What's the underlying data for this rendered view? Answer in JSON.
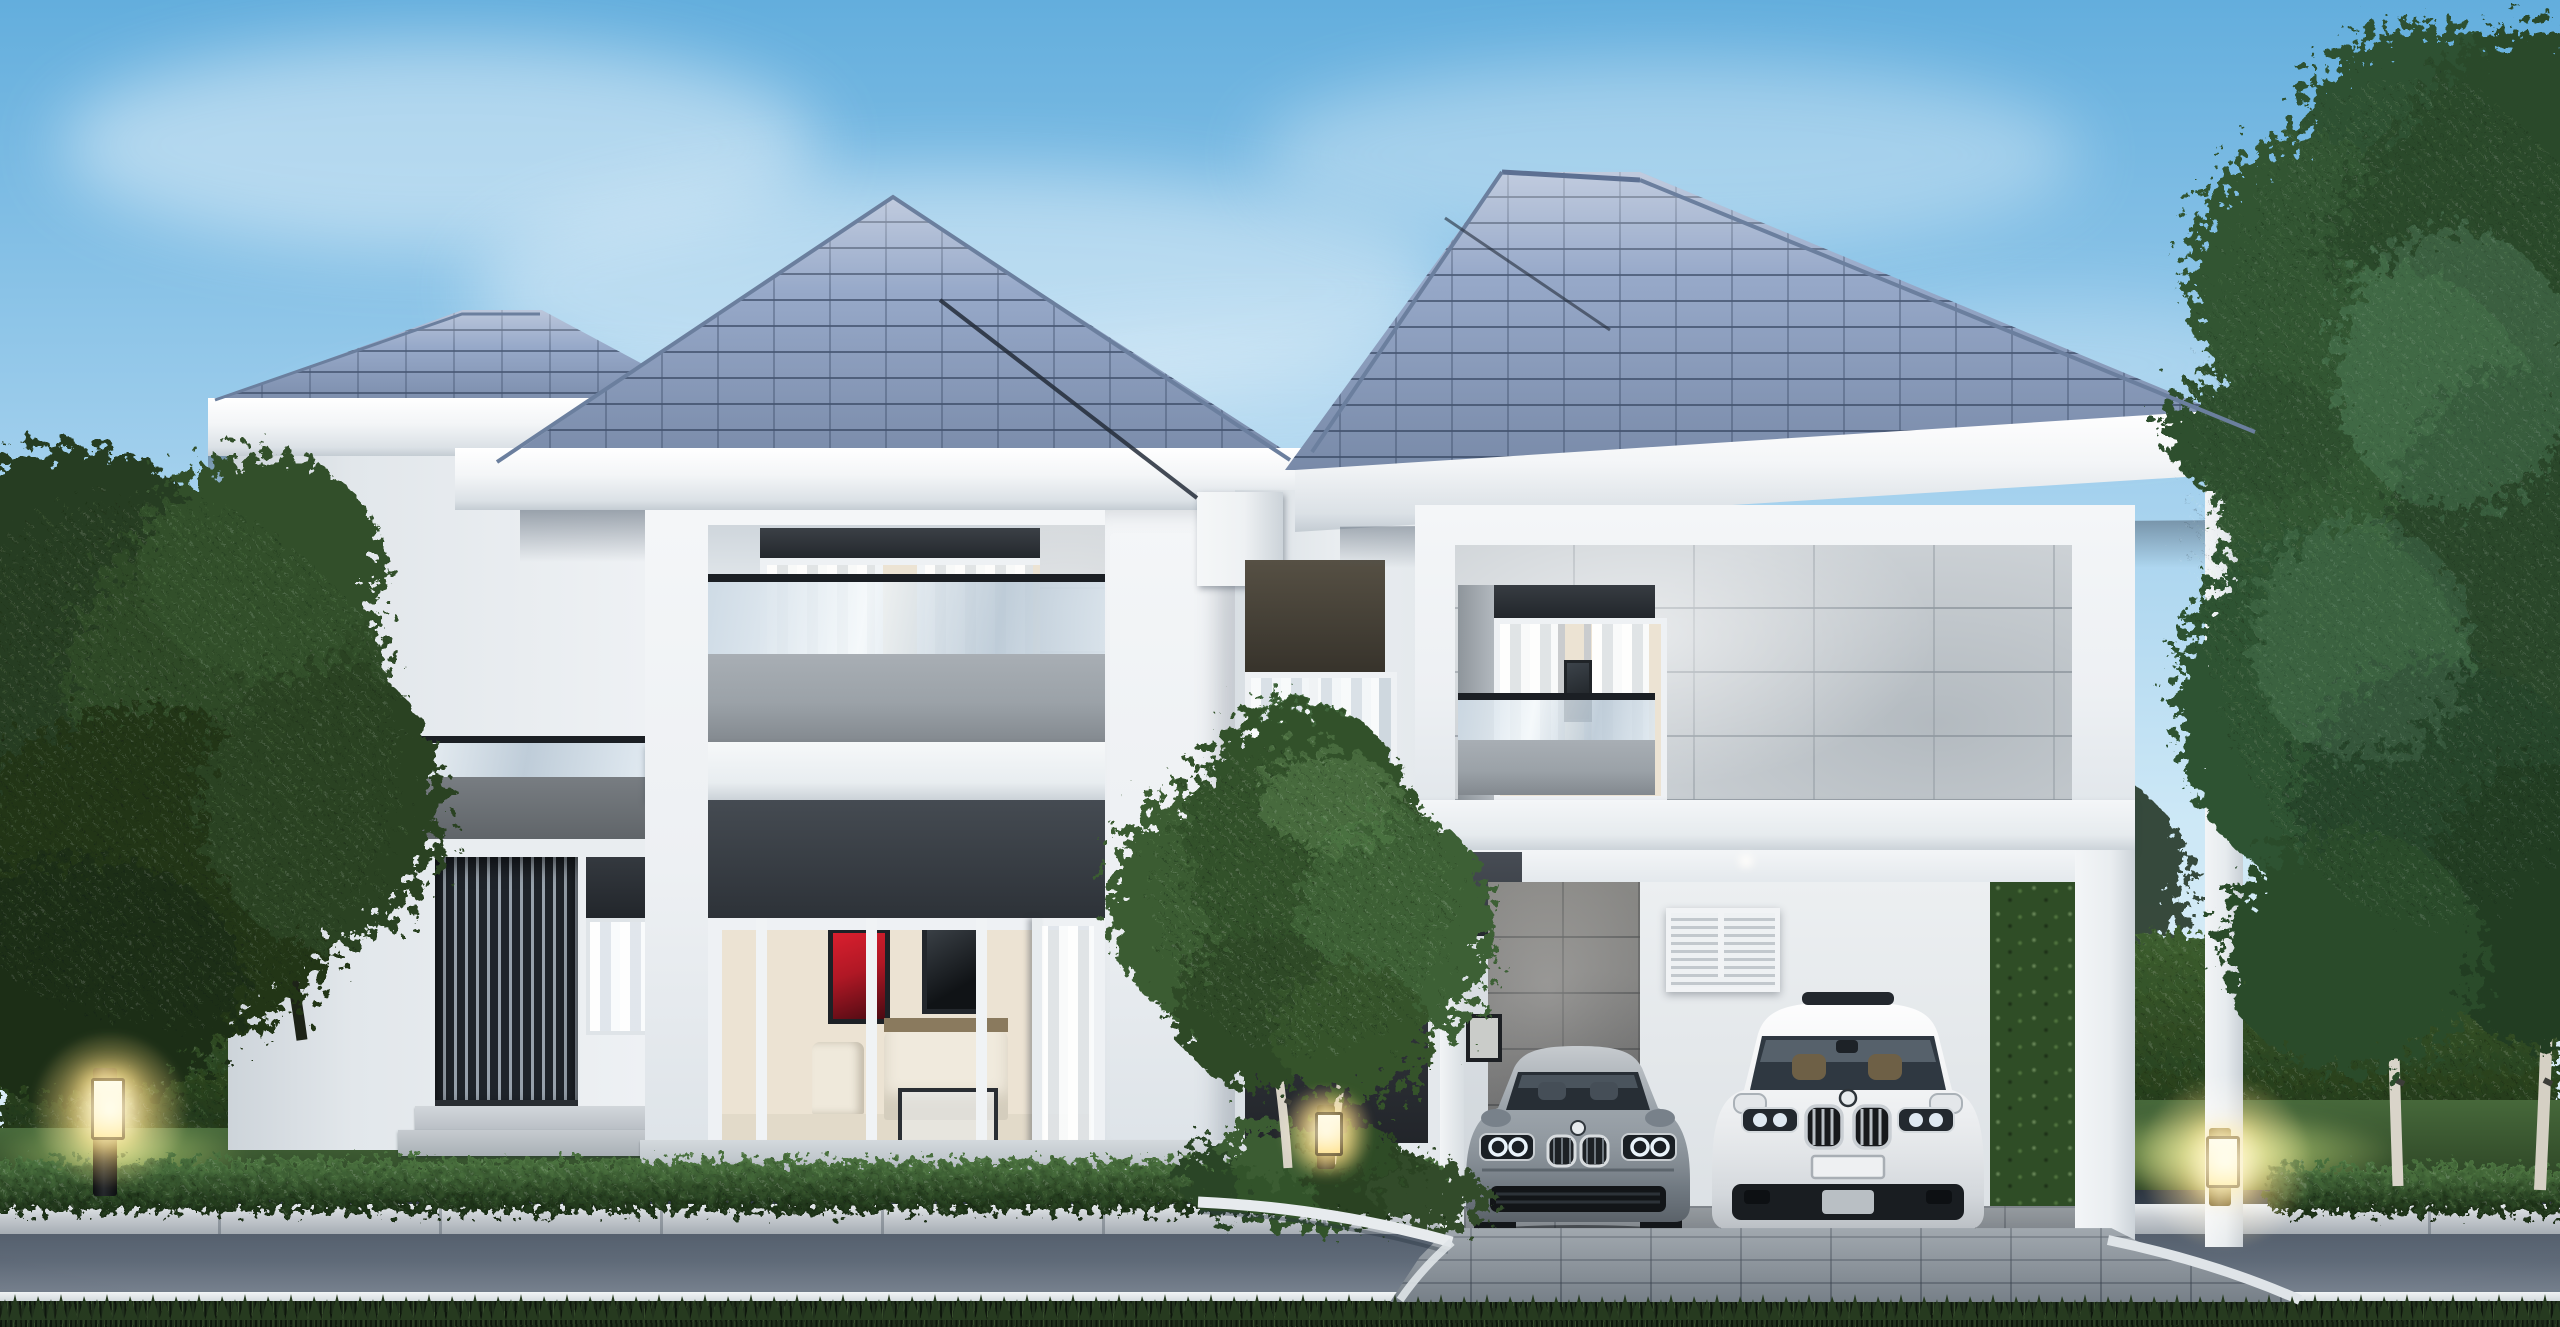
{
  "scene": {
    "type": "architectural-exterior-render",
    "subject": "modern two-storey detached house at dusk",
    "view": "front elevation from street",
    "elements": [
      "hip roof with slate tiles",
      "white render walls",
      "stone tile cladding",
      "carport with two cars",
      "landscaped garden",
      "asphalt road foreground"
    ]
  },
  "palette": {
    "sky_top": "#63aedd",
    "sky_mid": "#a6d2ee",
    "sky_low": "#cde8f6",
    "roof_tile": "#97a9c9",
    "fascia": "#f3f5f7",
    "wall": "#edf0f3",
    "stone": "#ced3d7",
    "panel_dark": "#3c4148",
    "charcoal": "#33373d",
    "parapet": "#9ba2a8",
    "rail": "#1b1f24",
    "hedge": "#2a431f",
    "lawn": "#35502c",
    "curb_dark": "#333d4a",
    "curb_stone": "#c5cacf",
    "road": "#5f6a78",
    "grass_fg": "#20301c",
    "paver": "#98a1a9",
    "lamp_glow": "#ffd685",
    "sedan_body": "#8d969e",
    "suv_body": "#edeff1",
    "interior_warm": "#ece3d3",
    "art_red": "#b01825"
  },
  "house": {
    "left_rear_wing": {
      "features": [
        "hip-roof",
        "balcony-glass-railing",
        "gray-spandrel-panel",
        "vertical-slat-screen",
        "side-window",
        "stone-steps"
      ]
    },
    "left_front_wing": {
      "features": [
        "hip-roof",
        "recessed-balcony",
        "sheer-curtains",
        "stone-pier",
        "glass-balcony-railing",
        "gray-parapet",
        "living-room-sliding-doors",
        "red-artwork",
        "dark-artwork",
        "cream-sofa",
        "armchair",
        "glass-coffee-table",
        "terrace-step"
      ]
    },
    "middle_section": {
      "features": [
        "valley-parapet-box",
        "bronze-transom",
        "tall-mullioned-window",
        "charcoal-feature-wall",
        "planting-bed",
        "white-garden-curb"
      ]
    },
    "right_wing": {
      "features": [
        "hip-roof",
        "stone-clad-upper-box",
        "recessed-balcony-window",
        "glass-railing",
        "carport",
        "ceiling-downlight",
        "interior-stone-wall",
        "louvered-shutter-window",
        "framed-photo",
        "corner-columns"
      ]
    }
  },
  "vehicles": [
    {
      "name": "luxury-sedan",
      "color_name": "silver-gray",
      "facing": "front",
      "details": [
        "twin-kidney-grille",
        "roundel-badge",
        "quad-ring-headlights",
        "black-lower-intake"
      ]
    },
    {
      "name": "luxury-suv",
      "color_name": "white",
      "facing": "front",
      "details": [
        "twin-kidney-grille",
        "roundel-badge",
        "sunroof",
        "blank-license-plate",
        "black-lower-bumper"
      ]
    }
  ],
  "landscape": {
    "garden_lamps": [
      {
        "position": "left-lawn",
        "style": "bollard",
        "lit": true
      },
      {
        "position": "center-planting-bed",
        "style": "mini-bollard",
        "lit": true
      },
      {
        "position": "right-lawn",
        "style": "bollard",
        "lit": true
      }
    ],
    "vegetation": [
      "left-foreground-tree",
      "right-foreground-tree-group",
      "background-hedge-wall",
      "front-low-hedge",
      "center-birch-tree",
      "right-birch-trunks",
      "planting-bed-shrubs",
      "foreground-grass-strip"
    ],
    "hardscape": [
      "asphalt-road",
      "white-road-line",
      "stone-curb",
      "paver-driveway",
      "terrace-steps"
    ]
  },
  "lighting": {
    "time_of_day": "dusk",
    "lamps_lit": true,
    "sky_clouds": "wispy"
  }
}
